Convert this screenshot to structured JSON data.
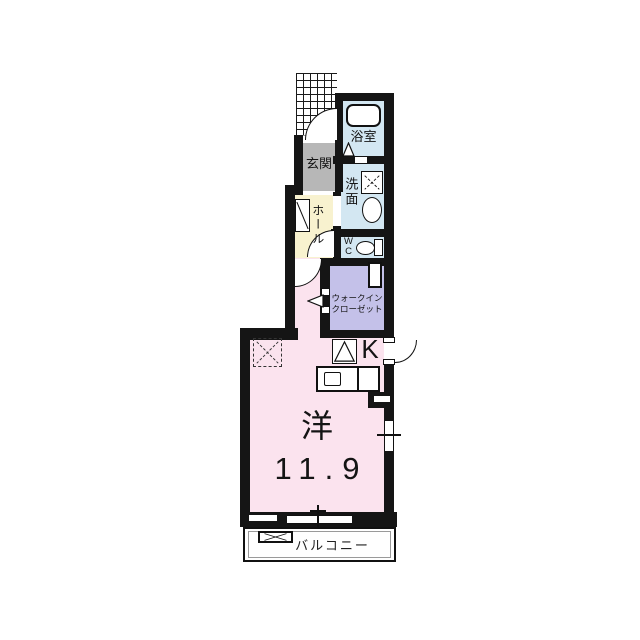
{
  "floorplan": {
    "title": "1R apartment floor plan",
    "rooms": {
      "genkan": {
        "label": "玄関"
      },
      "bathroom": {
        "label": "浴室"
      },
      "washroom": {
        "label": "洗面"
      },
      "hall": {
        "label": "ホール"
      },
      "wc": {
        "line1": "W",
        "line2": "C"
      },
      "walk_in_closet": {
        "line1": "ウォークイン",
        "line2": "クローゼット"
      },
      "kitchen": {
        "label": "K"
      },
      "main_room": {
        "type_label": "洋",
        "size_label": "11.9"
      },
      "balcony": {
        "label": "バルコニー"
      }
    },
    "fixtures": {
      "bathtub": "rounded rectangle tub",
      "washing_machine_space": "square with X",
      "wash_basin": "oval sink",
      "toilet": "bowl with tank",
      "shoe_cabinet": "rectangle with diagonal",
      "refrigerator_space": "dashed square with X",
      "stove": "square with triangle",
      "kitchen_counter": "counter with sink",
      "washing_pan": "rectangle with X on balcony",
      "entry_porch": "hatched grid area",
      "door_swings": "quarter-circle arcs",
      "windows": "double-line symbols with tick"
    },
    "colors": {
      "main_room_pink": "#fbe3ee",
      "hall_cream": "#f8f2cf",
      "wet_area_blue": "#d3e7f2",
      "closet_lavender": "#c4c1e9",
      "genkan_gray": "#b7b7b7",
      "wall_black": "#151515",
      "balcony_inner_gray": "#9a9a9a"
    }
  }
}
